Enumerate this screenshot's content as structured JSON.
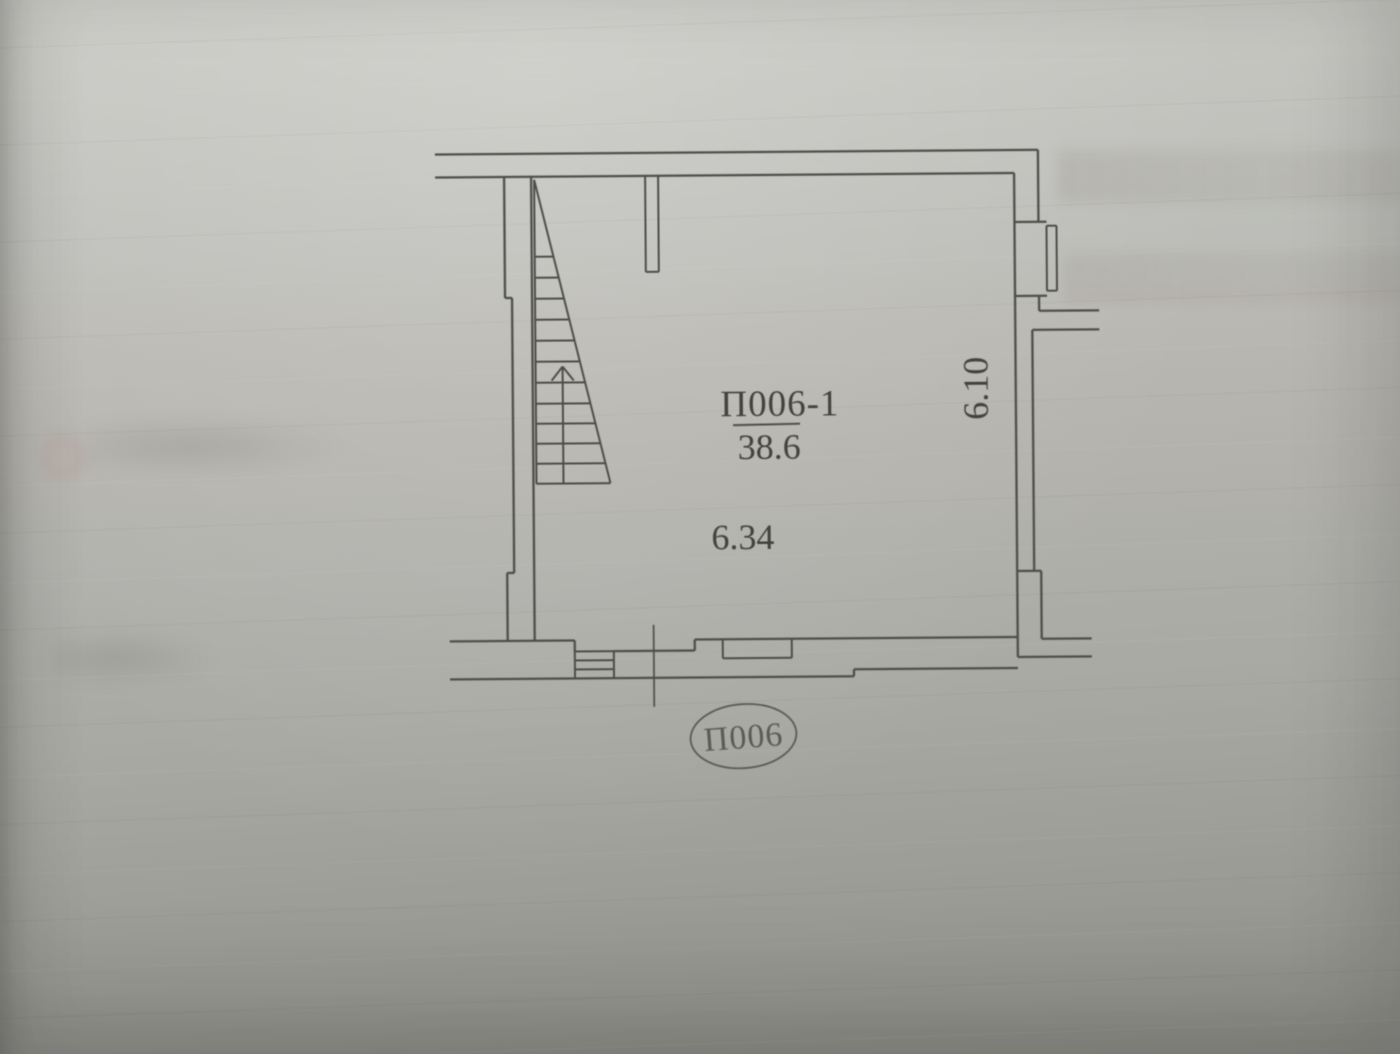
{
  "plan": {
    "room_label": "П006-1",
    "room_area": "38.6",
    "width_dimension": "6.34",
    "height_dimension": "6.10",
    "stamp_label": "П006"
  },
  "colors": {
    "paper_top": "#cbcbc6",
    "paper_mid": "#b3b4af",
    "paper_bottom": "#8e8e88",
    "ink": "#4e4e48",
    "ink_text": "#43423c",
    "stamp_ink": "#5c5b54"
  }
}
